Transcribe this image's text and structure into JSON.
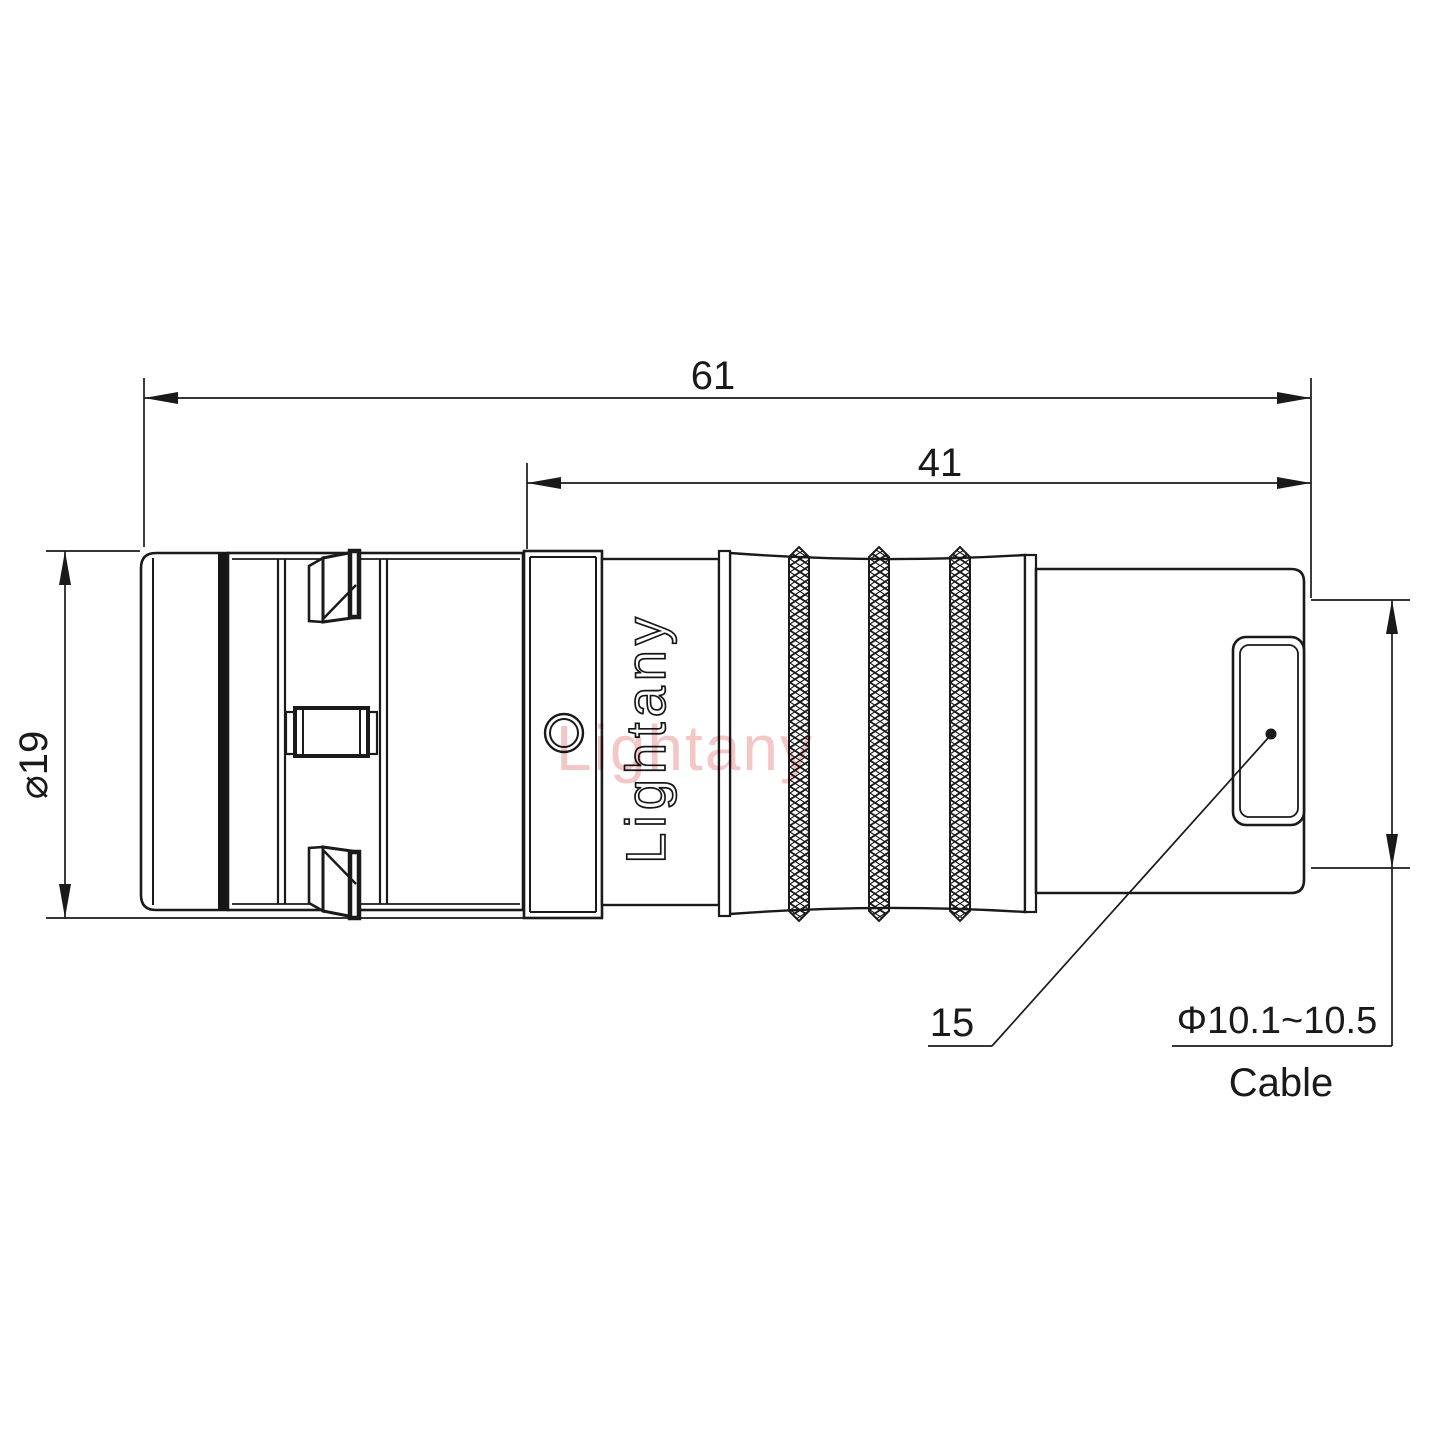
{
  "drawing": {
    "dim_overall_length": "61",
    "dim_rear_length": "41",
    "dim_front_diameter": "⌀19",
    "dim_cable_range": "Φ10.1~10.5",
    "dim_cable_label": "Cable",
    "leader_ref_number": "15",
    "brand_engraving": "Lightany",
    "brand_watermark": "Lightany"
  },
  "colors": {
    "line": "#1a1a1a",
    "watermark": "#e98f8f",
    "background": "#ffffff"
  }
}
